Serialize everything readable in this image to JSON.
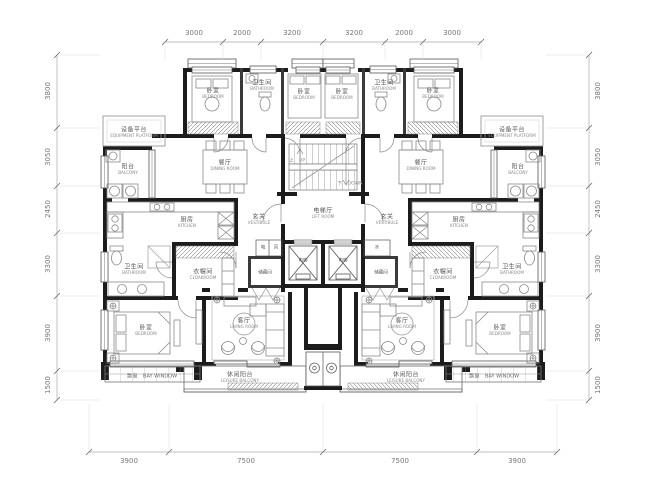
{
  "plan": {
    "rooms": {
      "equipment_platform": {
        "cn": "设备平台",
        "en": "EQUIPMENT PLATFORM"
      },
      "bedroom": {
        "cn": "卧室",
        "en": "BEDROOM"
      },
      "bathroom": {
        "cn": "卫生间",
        "en": "BATHROOM"
      },
      "balcony": {
        "cn": "阳台",
        "en": "BALCONY"
      },
      "dining": {
        "cn": "餐厅",
        "en": "DINING ROOM"
      },
      "kitchen": {
        "cn": "厨房",
        "en": "KITCHEN"
      },
      "vestibule": {
        "cn": "玄关",
        "en": "VESTIBULE"
      },
      "cloakroom": {
        "cn": "衣帽间",
        "en": "CLOAKROOM"
      },
      "living": {
        "cn": "客厅",
        "en": "LIVING ROOM"
      },
      "bay_window": {
        "cn": "飘窗",
        "en": "BAY WINDOW"
      },
      "leisure_balcony": {
        "cn": "休闲阳台",
        "en": "LEISURE BALCONY"
      },
      "lift_room": {
        "cn": "电梯厅",
        "en": "LIFT ROOM"
      },
      "elevator": {
        "cn": "电梯",
        "en": ""
      },
      "storage": {
        "cn": "储藏间",
        "en": ""
      },
      "up": {
        "cn": "上",
        "en": "UP"
      },
      "down": {
        "cn": "下",
        "en": "DOWN"
      },
      "shaft_electric": {
        "cn": "电",
        "en": ""
      },
      "shaft_vent": {
        "cn": "风",
        "en": ""
      },
      "shaft_water": {
        "cn": "水",
        "en": ""
      }
    },
    "dims": {
      "top": [
        "3000",
        "2000",
        "3200",
        "3200",
        "2000",
        "3000"
      ],
      "bottom": [
        "3900",
        "7500",
        "7500",
        "3900"
      ],
      "left": [
        "3800",
        "3050",
        "2450",
        "3300",
        "3900",
        "1500"
      ],
      "right": [
        "3800",
        "3050",
        "2450",
        "3300",
        "3900",
        "1500"
      ]
    },
    "colors": {
      "wall": "#1c1c1c",
      "partition": "#3a3a3a",
      "furniture": "#8a8a8a",
      "dimension": "#777777"
    }
  }
}
